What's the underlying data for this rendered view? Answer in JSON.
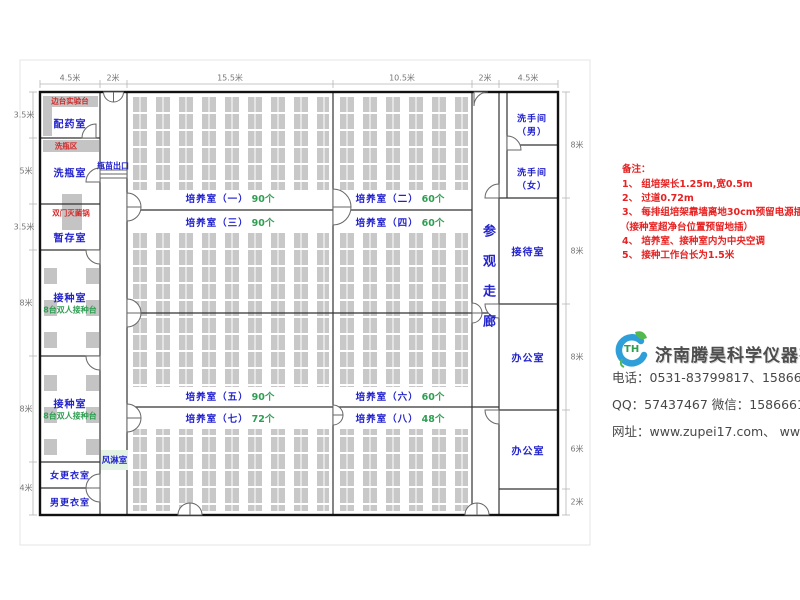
{
  "colors": {
    "label_blue": "#2323cd",
    "count_green": "#2e9e52",
    "note_red": "#e62222",
    "shelf_gray": "#c8c8c8",
    "wall": "#1a1a1a"
  },
  "dimensions": {
    "top": [
      "4.5米",
      "2米",
      "15.5米",
      "10.5米",
      "2米",
      "4.5米"
    ],
    "left": [
      "3.5米",
      "5米",
      "3.5米",
      "8米",
      "8米",
      "4米"
    ],
    "right": [
      "8米",
      "8米",
      "8米",
      "6米",
      "2米"
    ]
  },
  "rooms": {
    "peiyao": "配药室",
    "xiping": "洗瓶室",
    "zancun": "暂存室",
    "jiezhong1": "接种室",
    "jiezhong1_sub": "8台双人接种台",
    "jiezhong2": "接种室",
    "jiezhong2_sub": "8台双人接种台",
    "nv_gengyi": "女更衣室",
    "nan_gengyi": "男更衣室",
    "fenglin": "风淋室",
    "xishoujian_nan_line1": "洗手间",
    "xishoujian_nan_line2": "（男）",
    "xishoujian_nv_line1": "洗手间",
    "xishoujian_nv_line2": "（女）",
    "jiedai": "接待室",
    "bangong1": "办公室",
    "bangong2": "办公室",
    "corridor": "参观走廊"
  },
  "fixtures": {
    "biantai": "边台实验台",
    "xipingqu": "洗瓶区",
    "shuangmen": "双门灭菌锅",
    "pingmiao": "瓶苗出口"
  },
  "culture_rooms": [
    {
      "name": "培养室（一）",
      "count": "90个"
    },
    {
      "name": "培养室（二）",
      "count": "60个"
    },
    {
      "name": "培养室（三）",
      "count": "90个"
    },
    {
      "name": "培养室（四）",
      "count": "60个"
    },
    {
      "name": "培养室（五）",
      "count": "90个"
    },
    {
      "name": "培养室（六）",
      "count": "60个"
    },
    {
      "name": "培养室（七）",
      "count": "72个"
    },
    {
      "name": "培养室（八）",
      "count": "48个"
    }
  ],
  "notes": {
    "title": "备注：",
    "items": [
      "1、 组培架长1.25m,宽0.5m",
      "2、 过道0.72m",
      "3、 每排组培架靠墙离地30cm预留电源插座",
      "（接种室超净台位置预留地插）",
      "4、 培养室、接种室内为中央空调",
      "5、 接种工作台长为1.5米"
    ]
  },
  "company": {
    "logo_text": "TH",
    "name": "济南腾昊科学仪器有限公司",
    "phone": "电话：0531-83799817、15866611552",
    "qq": "QQ：57437467    微信：15866611552",
    "web": "网址：www.zupei17.com、  www.cnhtkj.com"
  }
}
